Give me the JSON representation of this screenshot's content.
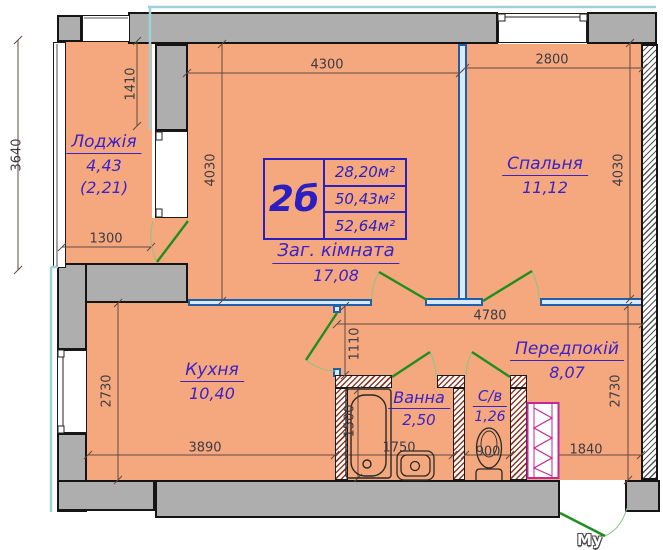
{
  "plan_title": "2б",
  "table": {
    "type_label": "2б",
    "rows": [
      "28,20м²",
      "50,43м²",
      "52,64м²"
    ]
  },
  "rooms": {
    "loggia": {
      "name": "Лоджія",
      "area": "4,43",
      "area2": "(2,21)"
    },
    "bedroom": {
      "name": "Спальня",
      "area": "11,12"
    },
    "living": {
      "name": "Заг. кімната",
      "area": "17,08"
    },
    "kitchen": {
      "name": "Кухня",
      "area": "10,40"
    },
    "bath": {
      "name": "Ванна",
      "area": "2,50"
    },
    "wc": {
      "name": "С/в",
      "area": "1,26"
    },
    "hall": {
      "name": "Передпокій",
      "area": "8,07"
    }
  },
  "dimensions": {
    "left_total": "3640",
    "loggia_niche": "1410",
    "loggia_width": "1300",
    "living_width": "4300",
    "living_height": "4030",
    "bedroom_width": "2800",
    "bedroom_height": "4030",
    "hall_width": "4780",
    "hall_corridor": "1110",
    "kitchen_height": "2730",
    "kitchen_width": "3890",
    "bath_length": "1500",
    "bath_width": "1750",
    "wc_width": "900",
    "hall_bottom": "1840",
    "hall_height": "2730"
  },
  "watermark": "My House",
  "icons": {
    "fixtures": [
      "bathtub-icon",
      "sink-icon",
      "toilet-icon",
      "vent-shaft-icon"
    ],
    "doors": [
      "balcony-door",
      "hallway-door",
      "bedroom-door",
      "kitchen-door",
      "bath-door",
      "wc-door",
      "entrance-door"
    ]
  },
  "colors": {
    "floor": "#F5A77E",
    "wall_gray": "#AEAEAE",
    "partition_blue": "#1E5FAF",
    "door_green": "#1E8F1E",
    "label_blue": "#3B23C8",
    "dim_text": "#3C3C44",
    "hatch_brown": "#8E3B28",
    "vent_magenta": "#C2289A",
    "exterior_cyan": "#9ED2D8"
  }
}
